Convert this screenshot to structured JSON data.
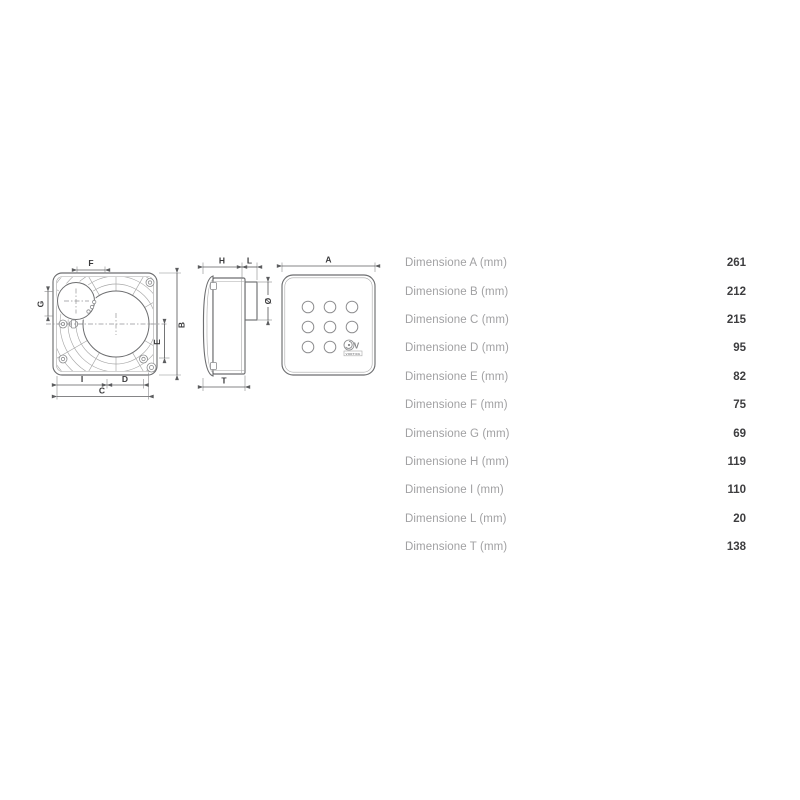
{
  "colors": {
    "c-bg": "#ffffff",
    "c-line": "#6d6e70",
    "c-thin": "#a8a8a8",
    "c-dim": "#5c5d5f",
    "c-dimtext": "#3a3a3c",
    "c-tlabel": "#a1a1a3",
    "c-tvalue": "#3d3d3f"
  },
  "diagram": {
    "labels": {
      "A": "A",
      "B": "B",
      "C": "C",
      "D": "D",
      "E": "E",
      "F": "F",
      "G": "G",
      "H": "H",
      "I": "I",
      "L": "L",
      "T": "T",
      "diameter": "Ø"
    },
    "logo": {
      "initial": "V",
      "brand": "VORTICE"
    }
  },
  "spec_table": {
    "rows": [
      {
        "label": "Dimensione A (mm)",
        "value": "261"
      },
      {
        "label": "Dimensione B (mm)",
        "value": "212"
      },
      {
        "label": "Dimensione C (mm)",
        "value": "215"
      },
      {
        "label": "Dimensione D (mm)",
        "value": "95"
      },
      {
        "label": "Dimensione E (mm)",
        "value": "82"
      },
      {
        "label": "Dimensione F (mm)",
        "value": "75"
      },
      {
        "label": "Dimensione G (mm)",
        "value": "69"
      },
      {
        "label": "Dimensione H (mm)",
        "value": "119"
      },
      {
        "label": "Dimensione I (mm)",
        "value": "110"
      },
      {
        "label": "Dimensione L (mm)",
        "value": "20"
      },
      {
        "label": "Dimensione T (mm)",
        "value": "138"
      }
    ]
  }
}
